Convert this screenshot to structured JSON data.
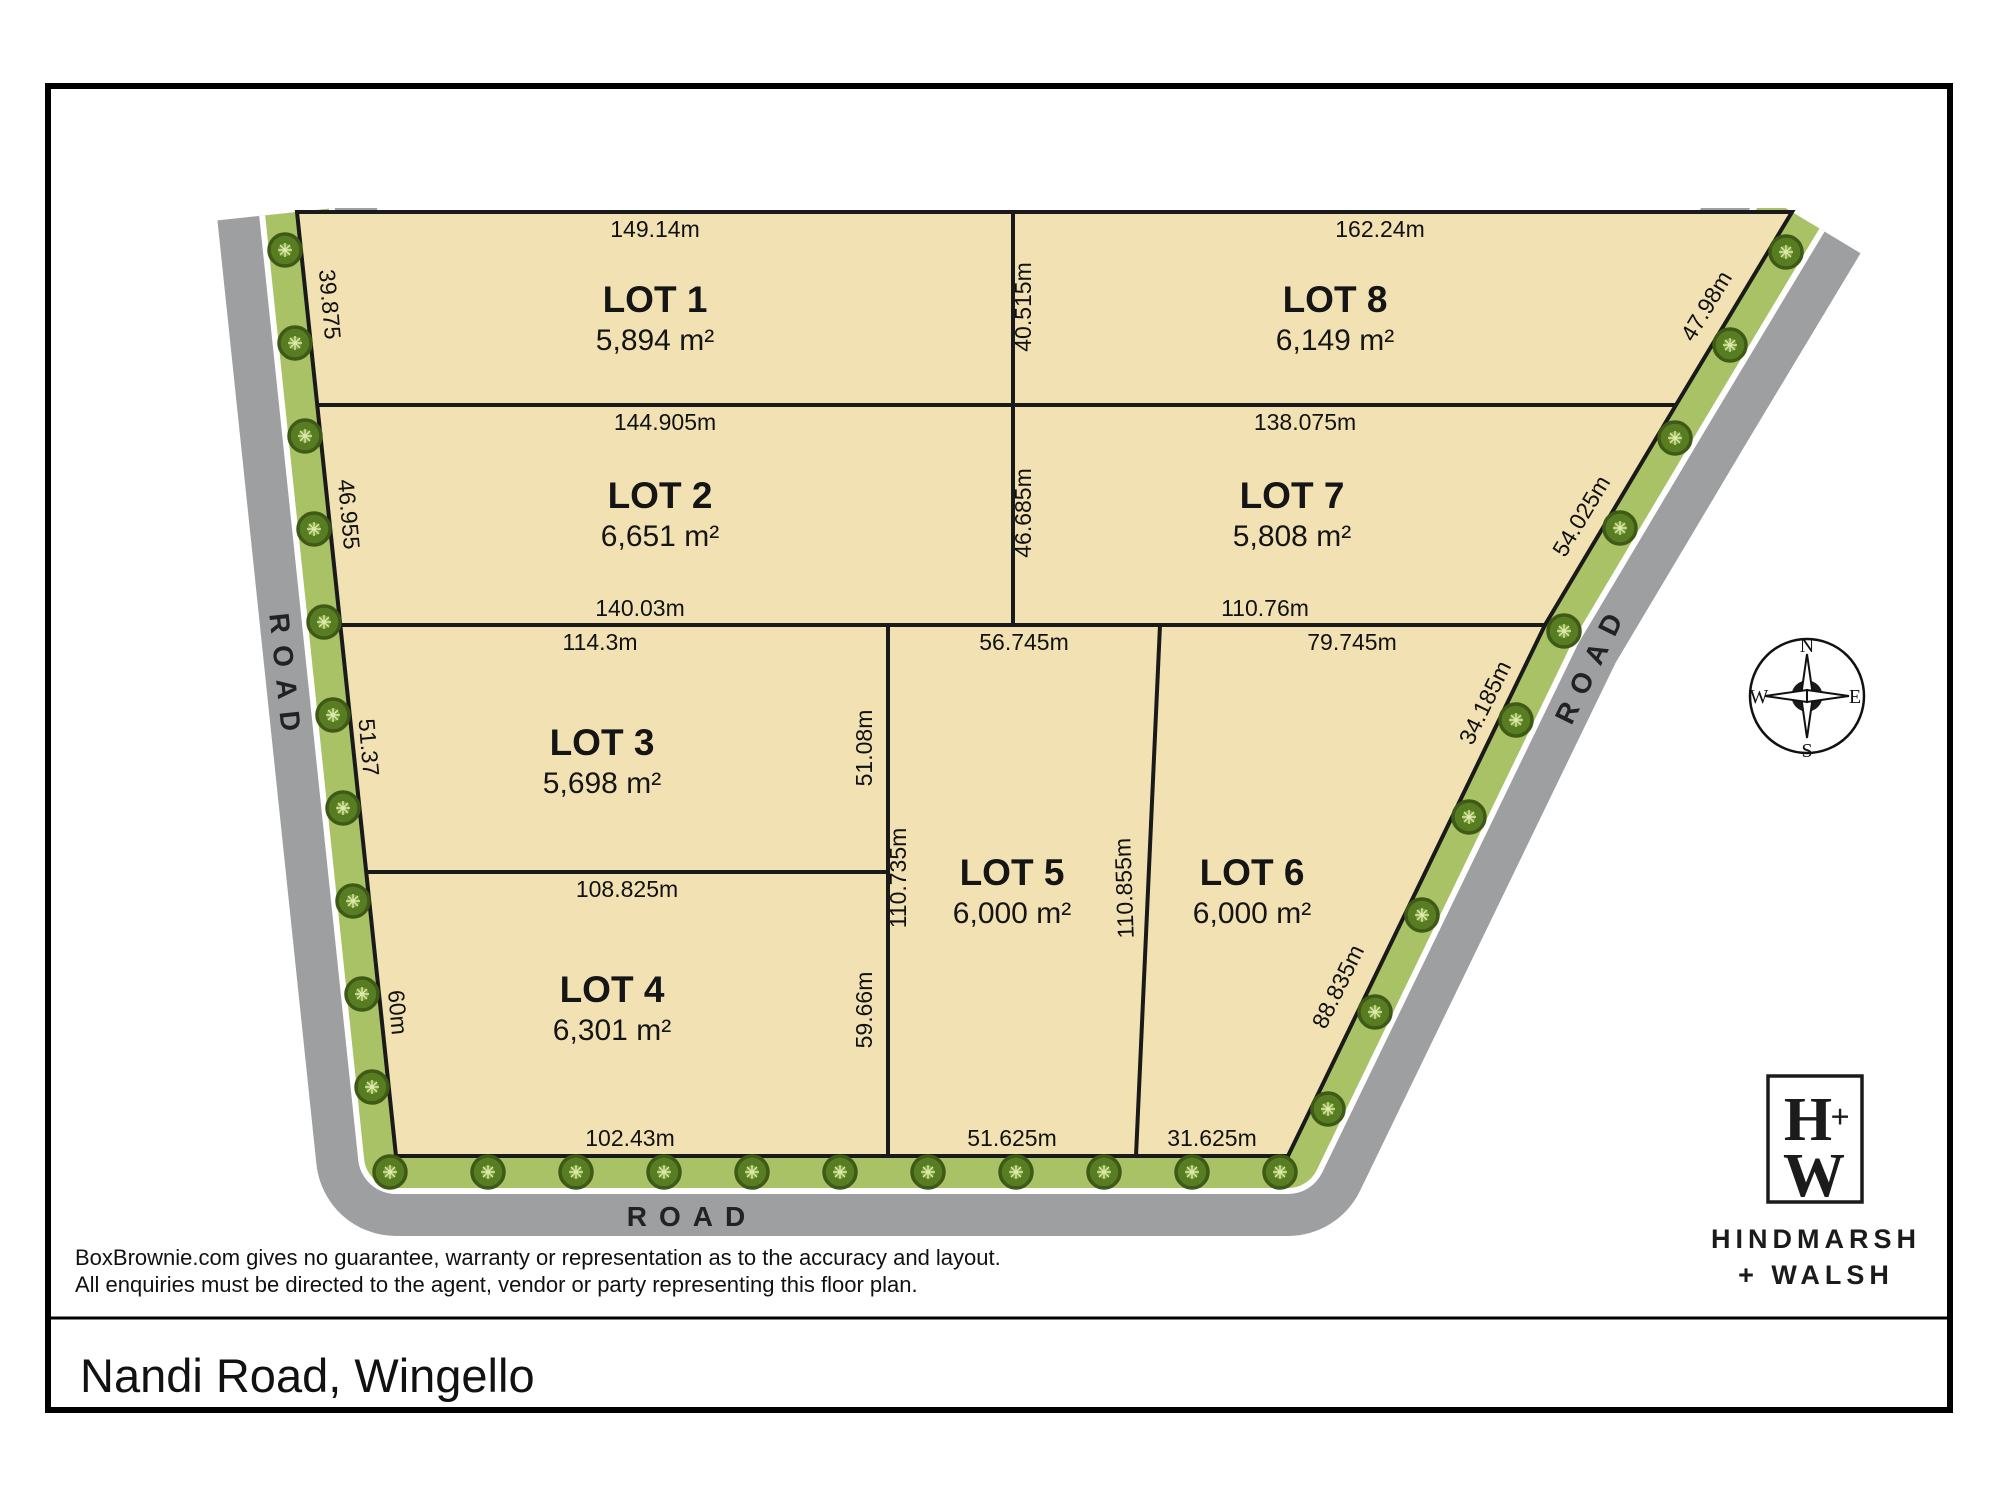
{
  "title": "Nandi Road, Wingello",
  "disclaimer": {
    "line1": "BoxBrownie.com gives no guarantee, warranty or representation as to the accuracy and layout.",
    "line2": "All enquiries must be directed to the agent, vendor or party representing this floor plan."
  },
  "branding": {
    "monogram_top": "H",
    "monogram_plus": "+",
    "monogram_bottom": "W",
    "name_line1": "HINDMARSH",
    "name_line2": "+ WALSH"
  },
  "compass": {
    "n": "N",
    "e": "E",
    "s": "S",
    "w": "W"
  },
  "road_labels": {
    "left": "ROAD",
    "bottom": "ROAD",
    "right": "ROAD"
  },
  "lots": [
    {
      "name": "LOT 1",
      "area": "5,894 m²"
    },
    {
      "name": "LOT 2",
      "area": "6,651 m²"
    },
    {
      "name": "LOT 3",
      "area": "5,698 m²"
    },
    {
      "name": "LOT 4",
      "area": "6,301 m²"
    },
    {
      "name": "LOT 5",
      "area": "6,000 m²"
    },
    {
      "name": "LOT 6",
      "area": "6,000 m²"
    },
    {
      "name": "LOT 7",
      "area": "5,808 m²"
    },
    {
      "name": "LOT 8",
      "area": "6,149 m²"
    }
  ],
  "dims": {
    "lot1_top": "149.14m",
    "lot8_top": "162.24m",
    "lot2_top": "144.905m",
    "lot7_top": "138.075m",
    "lot2_bottom": "140.03m",
    "lot7_bottom": "110.76m",
    "lot3_top": "114.3m",
    "lot5_top": "56.745m",
    "lot6_top": "79.745m",
    "lot4_top": "108.825m",
    "lot4_bottom": "102.43m",
    "lot5_bottom": "51.625m",
    "lot6_bottom": "31.625m",
    "lot1_left": "39.875",
    "lot2_left": "46.955",
    "lot3_left": "51.37",
    "lot4_left": "60m",
    "lot8_left": "40.515m",
    "lot7_left": "46.685m",
    "lot3_right": "51.08m",
    "lot5_left": "110.735m",
    "lot4_right": "59.66m",
    "lot5_right": "110.855m",
    "lot8_right": "47.98m",
    "lot7_right": "54.025m",
    "lot6_right_upper": "34.185m",
    "lot6_right_lower": "88.835m"
  },
  "colors": {
    "lot_fill": "#f2e2b3",
    "verge_green": "#a8c265",
    "road_gray": "#9d9fa1",
    "line_black": "#1a1a1a",
    "tree_green": "#587c22"
  }
}
